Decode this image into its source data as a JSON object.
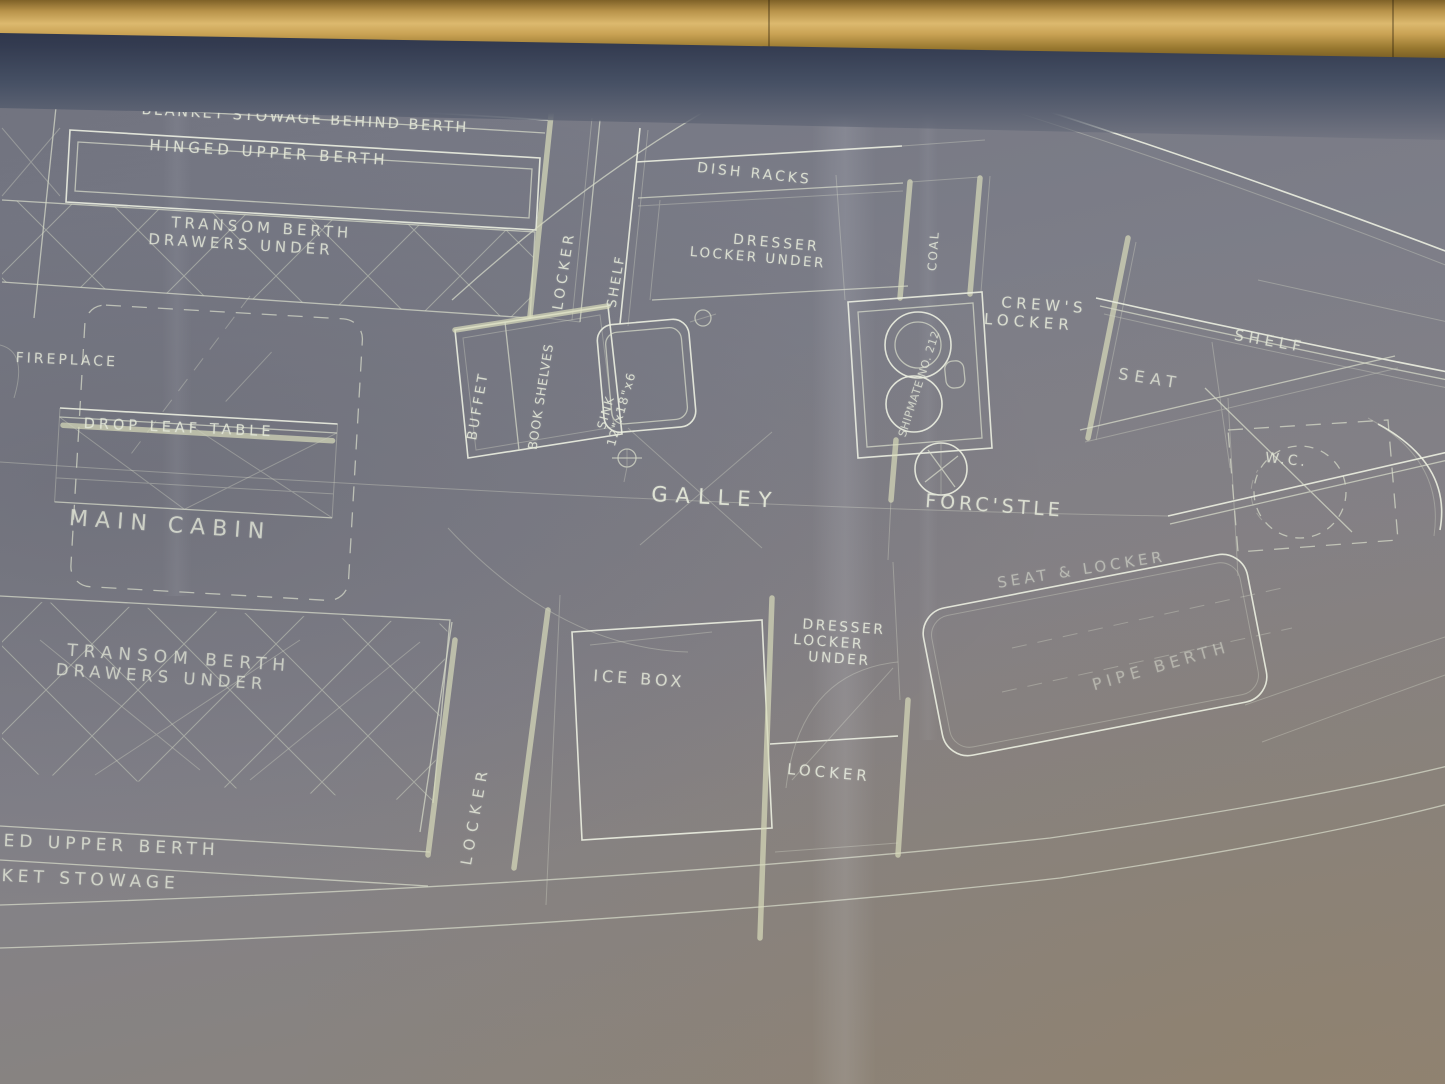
{
  "scene": {
    "description": "Photograph of a framed sailboat cabin-arrangement blueprint, gold frame along top edge, white hand-lettered plan on blue-gray paper",
    "colors": {
      "frame_gold": "#c9a254",
      "mat_navy": "#333b50",
      "paper_blue_gray": "#7d7e88",
      "paper_warm_corner": "#8d8478",
      "line_white": "#ecefe1",
      "tinted_line": "#d8dbba",
      "text": "#e4e8d9"
    }
  },
  "labels": {
    "blanket_stowage": "BLANKET STOWAGE BEHIND BERTH",
    "hinged_upper_berth": "HINGED UPPER BERTH",
    "transom_berth_fwd_line1": "TRANSOM BERTH",
    "transom_berth_fwd_line2": "DRAWERS UNDER",
    "dish_racks": "DISH RACKS",
    "dresser_fwd_line1": "DRESSER",
    "dresser_fwd_line2": "LOCKER UNDER",
    "coal": "COAL",
    "locker_fwd": "LOCKER",
    "shelf_fwd": "SHELF",
    "crews_locker_line1": "CREW'S",
    "crews_locker_line2": "LOCKER",
    "shelf_starboard": "SHELF",
    "seat": "SEAT",
    "fireplace": "FIREPLACE",
    "drop_leaf_table": "DROP LEAF TABLE",
    "buffet": "BUFFET",
    "book_shelves": "BOOK SHELVES",
    "sink_line1": "SINK",
    "sink_line2": "12\"x18\"x6",
    "stove": "SHIPMATE NO. 212",
    "galley": "GALLEY",
    "forecastle": "FORC'STLE",
    "wc": "W.C.",
    "main_cabin": "MAIN CABIN",
    "seat_and_locker": "SEAT & LOCKER",
    "pipe_berth": "PIPE BERTH",
    "transom_berth_aft_line1": "TRANSOM BERTH",
    "transom_berth_aft_line2": "DRAWERS UNDER",
    "ice_box": "ICE BOX",
    "dresser_aft_line1": "DRESSER",
    "dresser_aft_line2": "LOCKER",
    "dresser_aft_line3": "UNDER",
    "locker_aft": "LOCKER",
    "locker_galley": "LOCKER",
    "upper_berth_partial": "ED UPPER BERTH",
    "stowage_partial": "KET STOWAGE"
  }
}
